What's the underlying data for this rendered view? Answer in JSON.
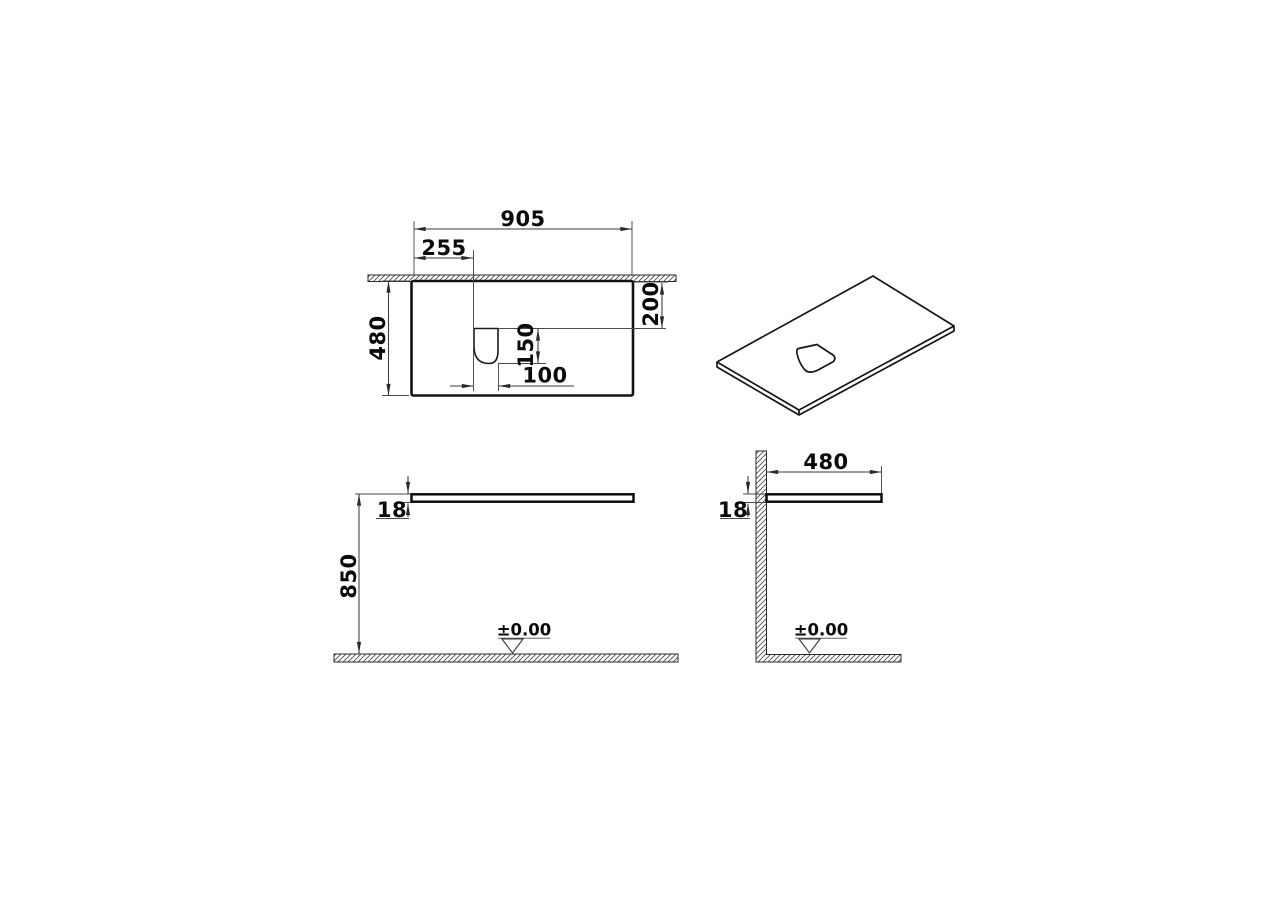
{
  "drawing": {
    "background_color": "#ffffff",
    "outline_color": "#141414",
    "dimension_line_color": "#3a3a3a",
    "plan_view": {
      "overall_width": "905",
      "cutout_left_offset": "255",
      "overall_depth": "480",
      "cutout_back_offset": "200",
      "cutout_depth": "150",
      "cutout_width": "100"
    },
    "front_view": {
      "mounting_height": "850",
      "panel_thickness": "18",
      "floor_datum": "±0.00"
    },
    "side_view": {
      "panel_depth": "480",
      "panel_thickness": "18",
      "floor_datum": "±0.00"
    }
  }
}
